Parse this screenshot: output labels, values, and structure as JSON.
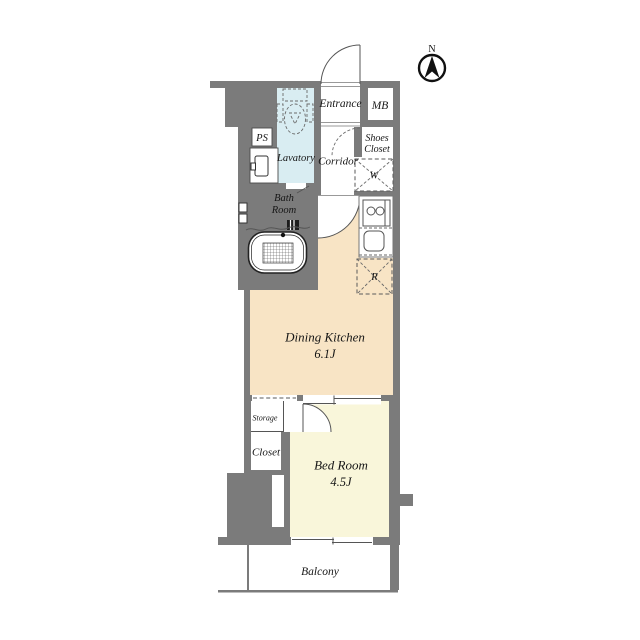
{
  "compass": {
    "label": "N"
  },
  "rooms": {
    "entrance": {
      "label": "Entrance"
    },
    "meter_box": {
      "label": "MB"
    },
    "shoes_closet": {
      "line1": "Shoes",
      "line2": "Closet"
    },
    "pipe_space": {
      "label": "PS"
    },
    "lavatory": {
      "label": "Lavatory"
    },
    "corridor": {
      "label": "Corridor"
    },
    "washer": {
      "label": "W"
    },
    "bath_room": {
      "line1": "Bath",
      "line2": "Room"
    },
    "refrigerator": {
      "label": "R"
    },
    "dining_kitchen": {
      "label": "Dining Kitchen",
      "size": "6.1J"
    },
    "storage": {
      "label": "Storage"
    },
    "closet": {
      "label": "Closet"
    },
    "bed_room": {
      "label": "Bed Room",
      "size": "4.5J"
    },
    "balcony": {
      "label": "Balcony"
    }
  },
  "colors": {
    "wall": "#7b7b7b",
    "water": "#d9edf2",
    "kitchen": "#f8e4c5",
    "bedfloor": "#f9f6da"
  }
}
